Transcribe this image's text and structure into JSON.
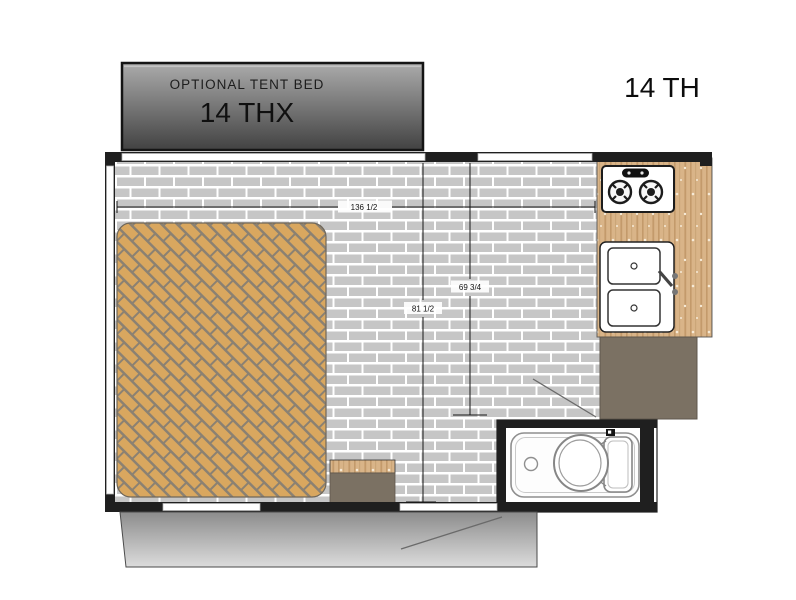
{
  "plan": {
    "title": "14 TH"
  },
  "tent_bed_box": {
    "label": "OPTIONAL TENT BED",
    "model": "14 THX"
  },
  "dimensions": {
    "overall_width": "136 1/2",
    "left_length": "81 1/2",
    "right_length": "69 3/4"
  },
  "colors": {
    "bed_fill": "#d9a75f",
    "bed_grout": "#8b8172",
    "floor_brick": "#c6c6c6",
    "counter_wood": "#d9b488",
    "cabinet": "#7b7163",
    "wall": "#1f1f1f",
    "ramp_top": "#8c8c8c",
    "ramp_bottom": "#dcdcdc"
  }
}
